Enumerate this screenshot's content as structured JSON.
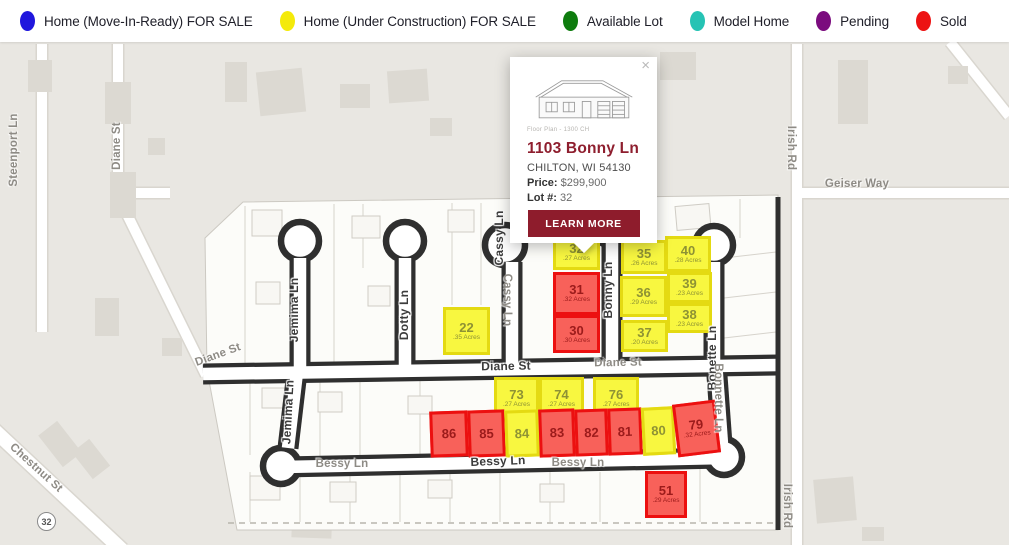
{
  "legend": {
    "items": [
      {
        "label": "Home (Move-In-Ready) FOR SALE",
        "color": "#2017dd"
      },
      {
        "label": "Home (Under Construction) FOR SALE",
        "color": "#f4ea0a"
      },
      {
        "label": "Available Lot",
        "color": "#0e7c0e"
      },
      {
        "label": "Model Home",
        "color": "#26c3b4"
      },
      {
        "label": "Pending",
        "color": "#7b0c7e"
      },
      {
        "label": "Sold",
        "color": "#ed1313"
      }
    ]
  },
  "popup": {
    "close": "×",
    "image_caption": "Floor Plan - 1300 CH",
    "title": "1103 Bonny Ln",
    "subtitle": "CHILTON, WI 54130",
    "price_label": "Price:",
    "price_value": "$299,900",
    "lot_label": "Lot #:",
    "lot_value": "32",
    "button": "LEARN MORE",
    "accent_color": "#8e1c2c"
  },
  "map": {
    "highway_badge": "32",
    "status_colors": {
      "under_construction": {
        "fill": "#f8f740",
        "border": "#e4da12",
        "text": "#8e9234"
      },
      "sold": {
        "fill": "#f8615a",
        "border": "#ec1010",
        "text": "#9c1b1b"
      }
    },
    "lots": [
      {
        "num": "32",
        "acres": ".27 Acres",
        "status": "under_construction",
        "x": 553,
        "y": 234,
        "w": 47,
        "h": 36,
        "rot": 0
      },
      {
        "num": "31",
        "acres": ".32 Acres",
        "status": "sold",
        "x": 553,
        "y": 272,
        "w": 47,
        "h": 43,
        "rot": 0
      },
      {
        "num": "30",
        "acres": ".30 Acres",
        "status": "sold",
        "x": 553,
        "y": 315,
        "w": 47,
        "h": 38,
        "rot": 0
      },
      {
        "num": "35",
        "acres": ".26 Acres",
        "status": "under_construction",
        "x": 621,
        "y": 240,
        "w": 46,
        "h": 34,
        "rot": 0
      },
      {
        "num": "40",
        "acres": ".28 Acres",
        "status": "under_construction",
        "x": 665,
        "y": 236,
        "w": 46,
        "h": 36,
        "rot": 0
      },
      {
        "num": "36",
        "acres": ".29 Acres",
        "status": "under_construction",
        "x": 620,
        "y": 276,
        "w": 47,
        "h": 41,
        "rot": 0
      },
      {
        "num": "39",
        "acres": ".23 Acres",
        "status": "under_construction",
        "x": 667,
        "y": 272,
        "w": 45,
        "h": 31,
        "rot": 0
      },
      {
        "num": "38",
        "acres": ".23 Acres",
        "status": "under_construction",
        "x": 667,
        "y": 303,
        "w": 45,
        "h": 30,
        "rot": 0
      },
      {
        "num": "37",
        "acres": ".20 Acres",
        "status": "under_construction",
        "x": 621,
        "y": 320,
        "w": 47,
        "h": 32,
        "rot": 0
      },
      {
        "num": "22",
        "acres": ".35 Acres",
        "status": "under_construction",
        "x": 443,
        "y": 307,
        "w": 47,
        "h": 48,
        "rot": 0
      },
      {
        "num": "73",
        "acres": ".27 Acres",
        "status": "under_construction",
        "x": 494,
        "y": 377,
        "w": 45,
        "h": 42,
        "rot": 0
      },
      {
        "num": "74",
        "acres": ".27 Acres",
        "status": "under_construction",
        "x": 539,
        "y": 377,
        "w": 45,
        "h": 42,
        "rot": 0
      },
      {
        "num": "76",
        "acres": ".27 Acres",
        "status": "under_construction",
        "x": 593,
        "y": 377,
        "w": 46,
        "h": 42,
        "rot": 0
      },
      {
        "num": "86",
        "acres": null,
        "status": "sold",
        "x": 430,
        "y": 411,
        "w": 38,
        "h": 46,
        "rot": -2
      },
      {
        "num": "85",
        "acres": null,
        "status": "sold",
        "x": 468,
        "y": 410,
        "w": 37,
        "h": 47,
        "rot": -2
      },
      {
        "num": "84",
        "acres": null,
        "status": "under_construction",
        "x": 505,
        "y": 410,
        "w": 34,
        "h": 47,
        "rot": -2
      },
      {
        "num": "83",
        "acres": null,
        "status": "sold",
        "x": 539,
        "y": 409,
        "w": 36,
        "h": 48,
        "rot": -2
      },
      {
        "num": "82",
        "acres": null,
        "status": "sold",
        "x": 575,
        "y": 409,
        "w": 33,
        "h": 47,
        "rot": -2
      },
      {
        "num": "81",
        "acres": null,
        "status": "sold",
        "x": 608,
        "y": 408,
        "w": 34,
        "h": 47,
        "rot": -2
      },
      {
        "num": "80",
        "acres": null,
        "status": "under_construction",
        "x": 642,
        "y": 407,
        "w": 33,
        "h": 48,
        "rot": -3
      },
      {
        "num": "79",
        "acres": ".32 Acres",
        "status": "sold",
        "x": 675,
        "y": 402,
        "w": 43,
        "h": 53,
        "rot": -7
      },
      {
        "num": "51",
        "acres": ".29 Acres",
        "status": "sold",
        "x": 645,
        "y": 471,
        "w": 42,
        "h": 47,
        "rot": 0
      }
    ],
    "street_labels": [
      {
        "text": "Jemima Ln",
        "x": 294,
        "y": 310,
        "rot": -90,
        "style": "bold"
      },
      {
        "text": "Jemima Ln",
        "x": 288,
        "y": 412,
        "rot": -87,
        "style": "bold"
      },
      {
        "text": "Dotty Ln",
        "x": 404,
        "y": 315,
        "rot": -90,
        "style": "bold"
      },
      {
        "text": "Cassy Ln",
        "x": 499,
        "y": 238,
        "rot": -90,
        "style": "bold"
      },
      {
        "text": "Bonny Ln",
        "x": 608,
        "y": 290,
        "rot": -90,
        "style": "bold"
      },
      {
        "text": "Bonette Ln",
        "x": 712,
        "y": 358,
        "rot": -90,
        "style": "bold"
      },
      {
        "text": "Diane St",
        "x": 506,
        "y": 366,
        "rot": -1,
        "style": "bold"
      },
      {
        "text": "Bessy Ln",
        "x": 498,
        "y": 461,
        "rot": -2,
        "style": "bold"
      },
      {
        "text": "Steenport Ln",
        "x": 14,
        "y": 150,
        "rot": -90,
        "style": "gray"
      },
      {
        "text": "Diane St",
        "x": 117,
        "y": 146,
        "rot": -90,
        "style": "gray"
      },
      {
        "text": "Diane St",
        "x": 218,
        "y": 355,
        "rot": -20,
        "style": "gray"
      },
      {
        "text": "Diane St",
        "x": 618,
        "y": 363,
        "rot": -1,
        "style": "gray"
      },
      {
        "text": "Bessy Ln",
        "x": 342,
        "y": 464,
        "rot": 0,
        "style": "gray"
      },
      {
        "text": "Bessy Ln",
        "x": 578,
        "y": 463,
        "rot": 0,
        "style": "gray"
      },
      {
        "text": "Cassy Ln",
        "x": 507,
        "y": 300,
        "rot": 90,
        "style": "gray"
      },
      {
        "text": "Bonnette Ln",
        "x": 718,
        "y": 398,
        "rot": 90,
        "style": "gray"
      },
      {
        "text": "Irish Rd",
        "x": 791,
        "y": 148,
        "rot": 90,
        "style": "gray"
      },
      {
        "text": "Irish Rd",
        "x": 787,
        "y": 506,
        "rot": 90,
        "style": "gray"
      },
      {
        "text": "Geiser Way",
        "x": 857,
        "y": 184,
        "rot": 0,
        "style": "gray"
      },
      {
        "text": "Chestnut St",
        "x": 36,
        "y": 468,
        "rot": 42,
        "style": "gray"
      }
    ]
  }
}
